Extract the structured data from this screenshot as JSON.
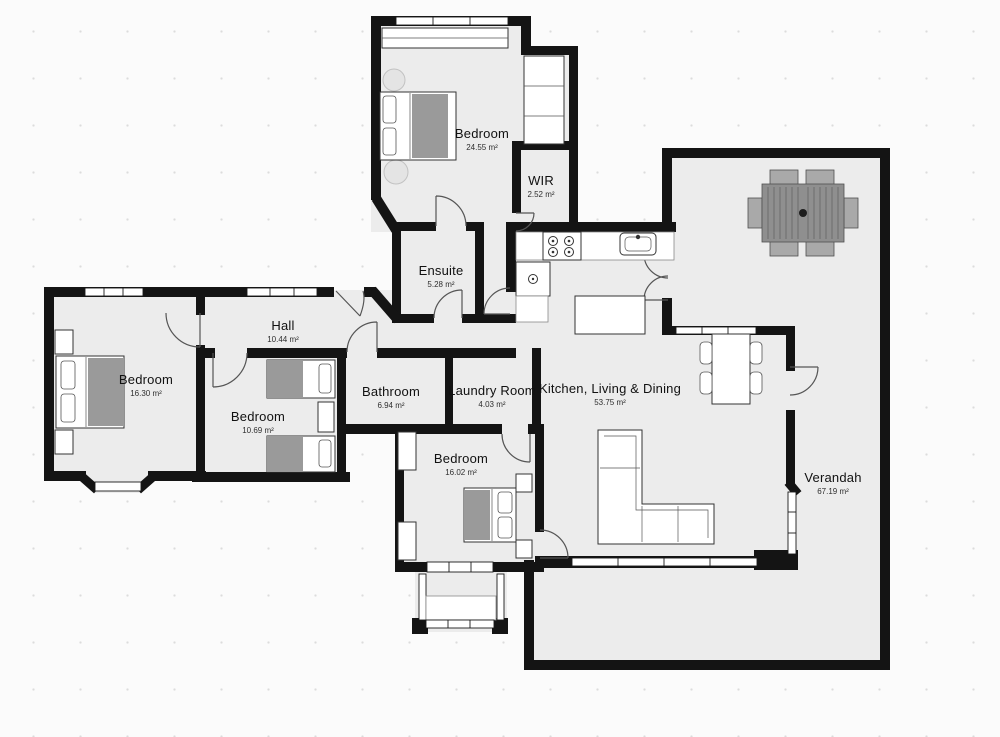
{
  "plan": {
    "title": "Floor Plan",
    "colors": {
      "wall": "#141414",
      "floor": "#ececec",
      "accent": "#9a9a9a"
    },
    "area_unit": "m²"
  },
  "rooms": [
    {
      "id": "bedroom-top",
      "name": "Bedroom",
      "area": "24.55 m²"
    },
    {
      "id": "wir",
      "name": "WIR",
      "area": "2.52 m²"
    },
    {
      "id": "ensuite",
      "name": "Ensuite",
      "area": "5.28 m²"
    },
    {
      "id": "hall",
      "name": "Hall",
      "area": "10.44 m²"
    },
    {
      "id": "bedroom-left",
      "name": "Bedroom",
      "area": "16.30 m²"
    },
    {
      "id": "bedroom-middle",
      "name": "Bedroom",
      "area": "10.69 m²"
    },
    {
      "id": "bathroom",
      "name": "Bathroom",
      "area": "6.94 m²"
    },
    {
      "id": "laundry",
      "name": "Laundry Room",
      "area": "4.03 m²"
    },
    {
      "id": "bedroom-bottom",
      "name": "Bedroom",
      "area": "16.02 m²"
    },
    {
      "id": "kitchen-living-dining",
      "name": "Kitchen, Living & Dining",
      "area": "53.75 m²"
    },
    {
      "id": "verandah",
      "name": "Verandah",
      "area": "67.19 m²"
    }
  ]
}
